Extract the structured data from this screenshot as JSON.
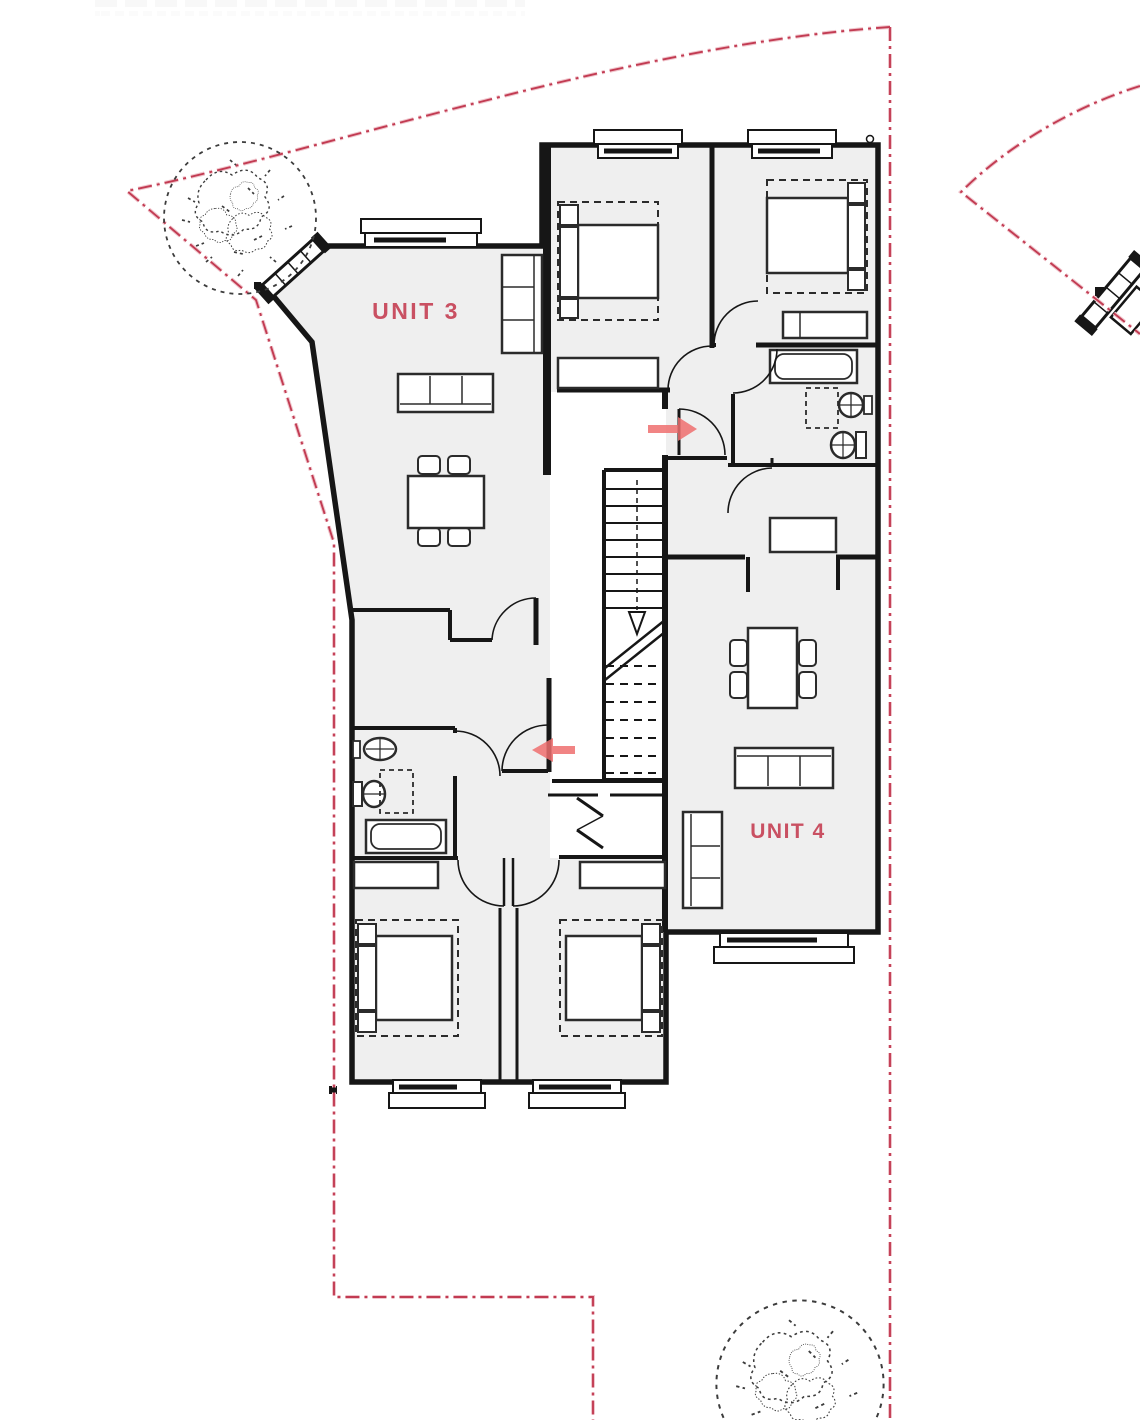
{
  "labels": {
    "unit3": "UNIT 3",
    "unit4": "UNIT 4"
  },
  "colors": {
    "boundary_red": "#c23b52",
    "boundary_halo": "#f0c6cd",
    "unit_label_red": "#c95062",
    "arrow_red": "#ee6e6e",
    "wall_black": "#161616",
    "floor_gray": "#efefef",
    "furniture_stroke": "#2b2b2b",
    "tree_gray": "#3c3c3c"
  },
  "site": {
    "boundary_line_style": "dash-dot",
    "tree_count": 2,
    "trees": [
      {
        "position": "top-left"
      },
      {
        "position": "bottom-right"
      }
    ]
  },
  "plan": {
    "entry_arrows": [
      {
        "unit": "UNIT 4",
        "direction": "right"
      },
      {
        "unit": "UNIT 3",
        "direction": "left"
      }
    ],
    "stairs": {
      "present": true,
      "solid_treads": 8,
      "dashed_treads": 8
    },
    "fixtures": [
      "bed",
      "bed",
      "bed",
      "bed",
      "sofa",
      "sofa",
      "sofa",
      "dining-table",
      "dining-table",
      "bathtub",
      "bathtub",
      "toilet",
      "toilet",
      "sink",
      "sink",
      "shower",
      "wardrobe",
      "wardrobe",
      "wardrobe",
      "shelving",
      "storage"
    ]
  }
}
